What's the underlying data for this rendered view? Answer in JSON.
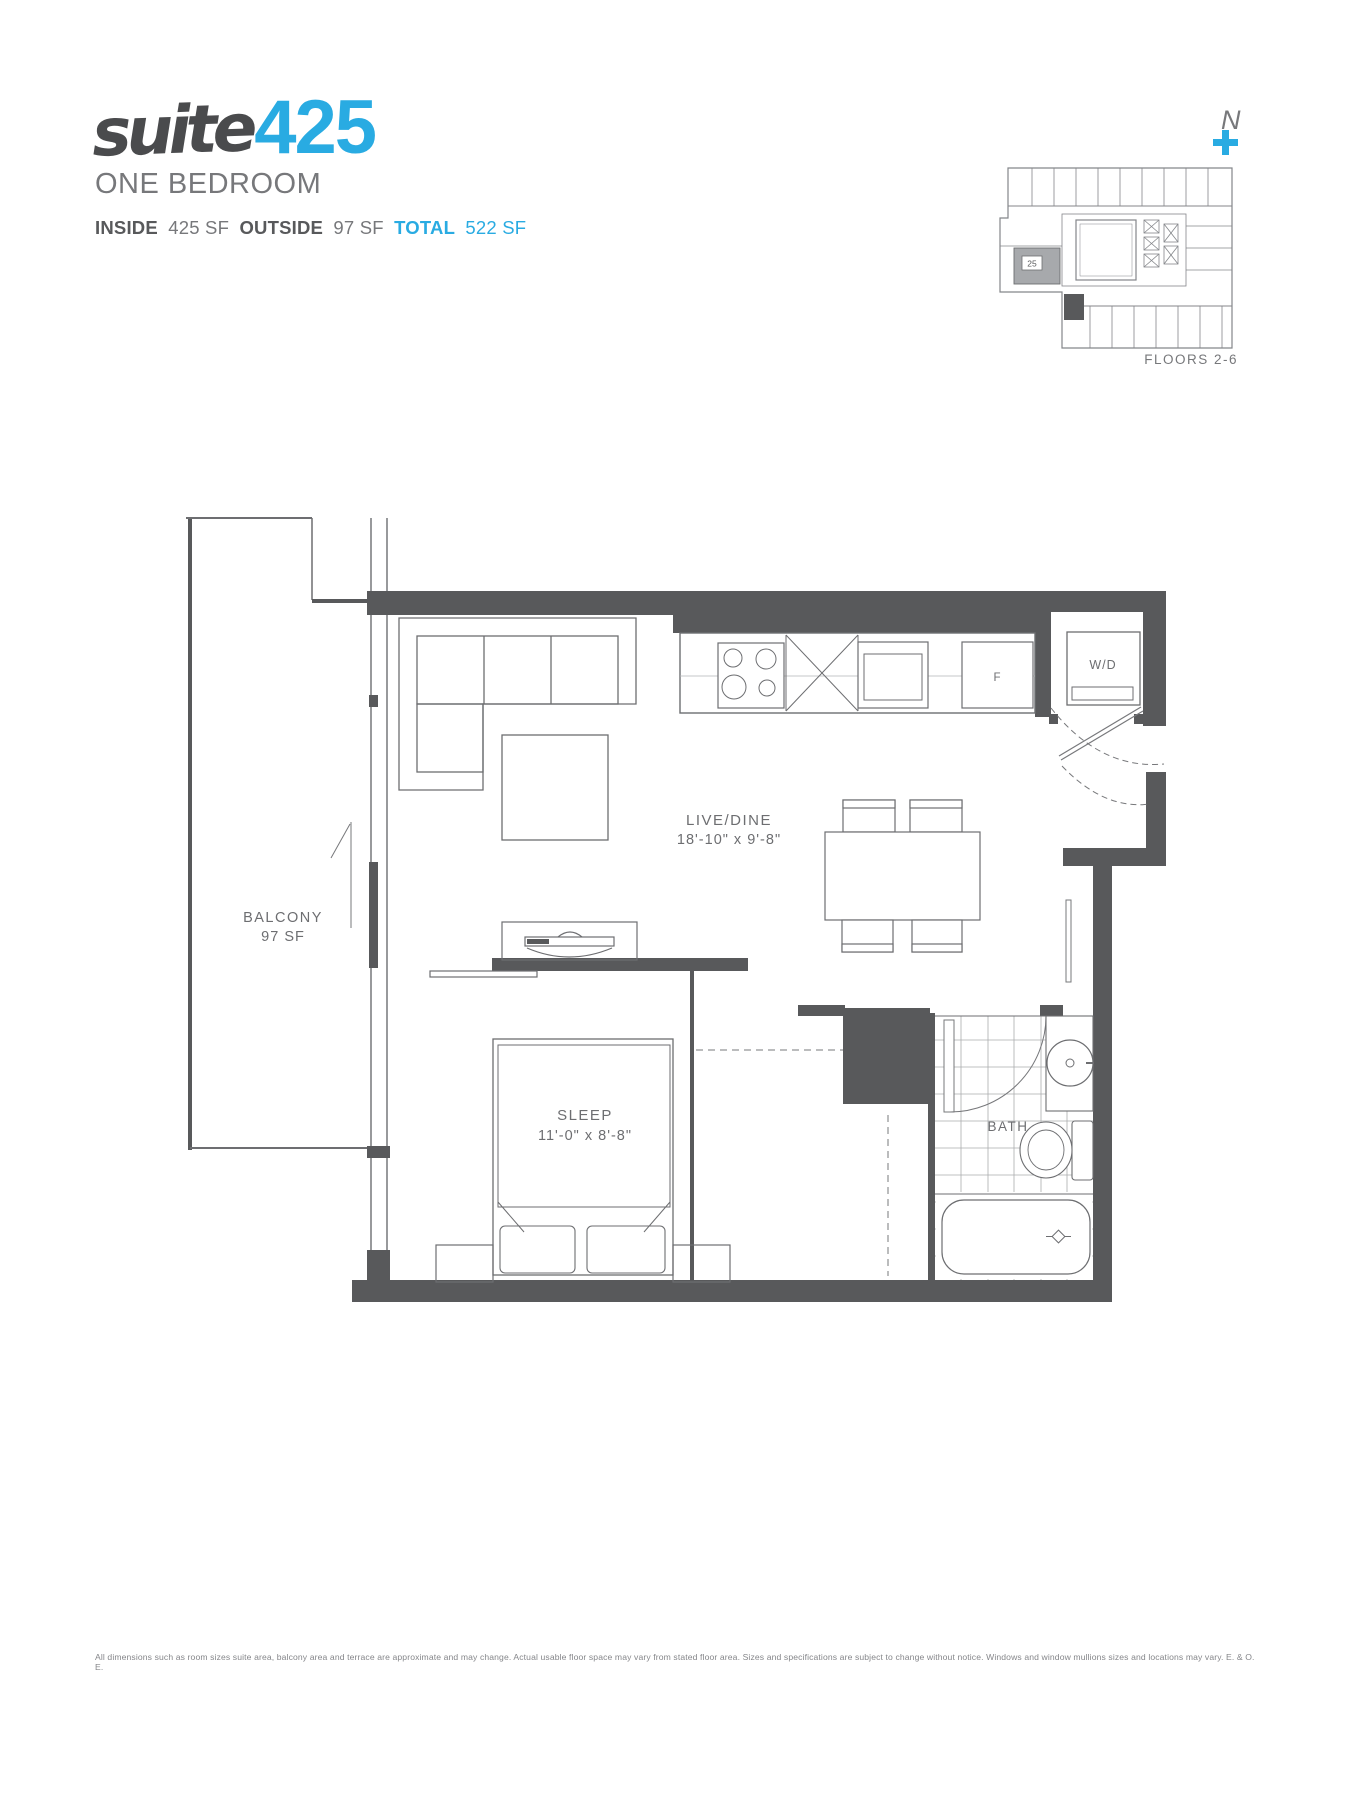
{
  "header": {
    "logo_script": "suite",
    "logo_number": "425",
    "subtitle": "ONE BEDROOM",
    "stats": {
      "inside_label": "INSIDE",
      "inside_value": "425 SF",
      "outside_label": "OUTSIDE",
      "outside_value": "97 SF",
      "total_label": "TOTAL",
      "total_value": "522 SF"
    }
  },
  "keyplan": {
    "compass_letter": "N",
    "floors_label": "FLOORS 2-6",
    "highlight_unit_label": "25"
  },
  "plan": {
    "balcony_name": "BALCONY",
    "balcony_area": "97 SF",
    "live_dine_name": "LIVE/DINE",
    "live_dine_dims": "18'-10\" x 9'-8\"",
    "sleep_name": "SLEEP",
    "sleep_dims": "11'-0\" x 8'-8\"",
    "bath_name": "BATH",
    "wd_label": "W/D",
    "fridge_label": "F"
  },
  "footer": {
    "disclaimer": "All dimensions such as room sizes suite area, balcony area and terrace are approximate and may change. Actual usable floor space may vary from stated floor area. Sizes and specifications are subject to change without notice. Windows and window mullions sizes and locations may vary. E. & O. E."
  },
  "colors": {
    "accent": "#29abe2",
    "wall": "#58595b",
    "gray": "#77787b"
  }
}
